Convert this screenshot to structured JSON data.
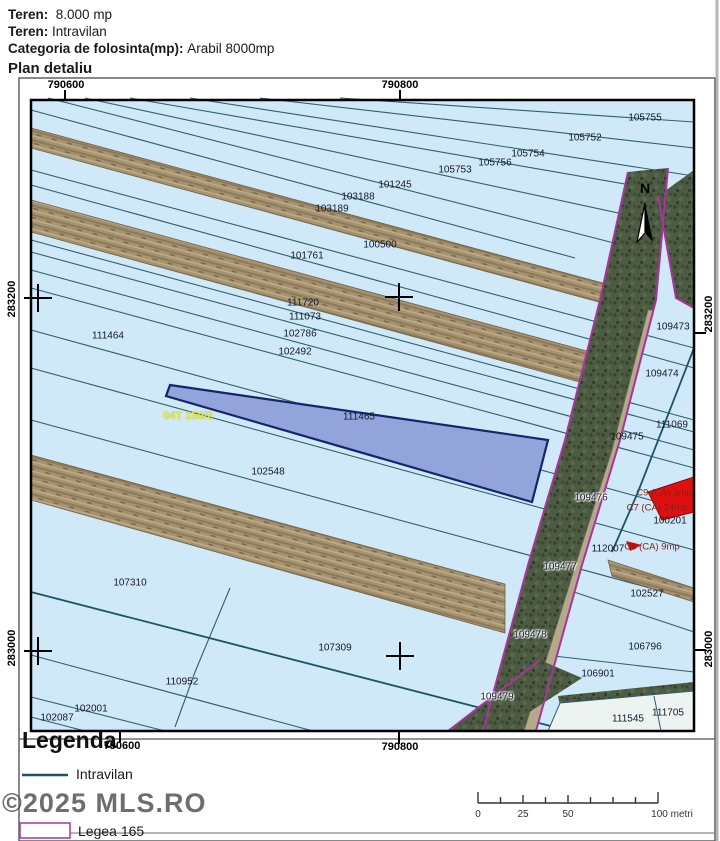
{
  "header": {
    "line1_label": "Teren:",
    "line1_value": "8.000 mp",
    "line2_label": "Teren:",
    "line2_value": "Intravilan",
    "line3_label": "Categoria de folosinta(mp):",
    "line3_value": "Arabil 8000mp",
    "title": "Plan detaliu"
  },
  "legend": {
    "title": "Legenda",
    "items": [
      {
        "symbol": "teal-line",
        "label": "Intravilan"
      },
      {
        "symbol": "magenta-rect",
        "label": "Legea 165"
      }
    ]
  },
  "watermark": "©2025 MLS.RO",
  "scale": {
    "labels": [
      "0",
      "25",
      "50",
      "100 metri"
    ]
  },
  "colors": {
    "map_bg": "#cfe9f8",
    "parcel_line": "#2f6070",
    "highlight_fill": "#93a4da",
    "highlight_border": "#16246e",
    "band_tan": "#a5926f",
    "band_green": "#4d5b43",
    "legea_magenta": "#a8359c",
    "intravilan_teal": "#1d5366",
    "red_parcel": "#e01010",
    "yellow_label": "#e9e93f"
  },
  "map": {
    "labels": [
      {
        "t": "790600",
        "x": 66,
        "y": 85,
        "c": "coord",
        "n": "coord-top-790600"
      },
      {
        "t": "790800",
        "x": 400,
        "y": 85,
        "c": "coord",
        "n": "coord-top-790800"
      },
      {
        "t": "790600",
        "x": 122,
        "y": 746,
        "c": "coord",
        "n": "coord-bottom-790600"
      },
      {
        "t": "790800",
        "x": 400,
        "y": 747,
        "c": "coord",
        "n": "coord-bottom-790800"
      },
      {
        "t": "283200",
        "x": 12,
        "y": 299,
        "c": "coordv",
        "n": "coord-left-283200"
      },
      {
        "t": "283000",
        "x": 12,
        "y": 648,
        "c": "coordv",
        "n": "coord-left-283000"
      },
      {
        "t": "283200",
        "x": 709,
        "y": 314,
        "c": "coordv",
        "n": "coord-right-283200"
      },
      {
        "t": "283000",
        "x": 709,
        "y": 649,
        "c": "coordv",
        "n": "coord-right-283000"
      },
      {
        "t": "N",
        "x": 645,
        "y": 188,
        "c": "n",
        "n": "north-label"
      },
      {
        "t": "105755",
        "x": 645,
        "y": 118
      },
      {
        "t": "105752",
        "x": 585,
        "y": 138
      },
      {
        "t": "105754",
        "x": 528,
        "y": 154
      },
      {
        "t": "105756",
        "x": 495,
        "y": 163
      },
      {
        "t": "105753",
        "x": 455,
        "y": 170
      },
      {
        "t": "101245",
        "x": 395,
        "y": 185
      },
      {
        "t": "103188",
        "x": 358,
        "y": 197
      },
      {
        "t": "103189",
        "x": 332,
        "y": 209
      },
      {
        "t": "100500",
        "x": 380,
        "y": 245
      },
      {
        "t": "101761",
        "x": 307,
        "y": 256
      },
      {
        "t": "111720",
        "x": 303,
        "y": 303
      },
      {
        "t": "111073",
        "x": 305,
        "y": 317
      },
      {
        "t": "102786",
        "x": 300,
        "y": 334
      },
      {
        "t": "102492",
        "x": 295,
        "y": 352
      },
      {
        "t": "111464",
        "x": 108,
        "y": 336
      },
      {
        "t": "111465",
        "x": 359,
        "y": 417
      },
      {
        "t": "04T 150/2",
        "x": 188,
        "y": 416,
        "c": "y",
        "n": "tarla-label"
      },
      {
        "t": "102548",
        "x": 268,
        "y": 472
      },
      {
        "t": "107310",
        "x": 130,
        "y": 583
      },
      {
        "t": "107309",
        "x": 335,
        "y": 648
      },
      {
        "t": "110952",
        "x": 182,
        "y": 682
      },
      {
        "t": "102001",
        "x": 91,
        "y": 709
      },
      {
        "t": "102087",
        "x": 57,
        "y": 718
      },
      {
        "t": "109473",
        "x": 673,
        "y": 327
      },
      {
        "t": "109474",
        "x": 662,
        "y": 374
      },
      {
        "t": "111069",
        "x": 672,
        "y": 425
      },
      {
        "t": "109475",
        "x": 627,
        "y": 437
      },
      {
        "t": "109476",
        "x": 591,
        "y": 498,
        "c": "halo"
      },
      {
        "t": "109477",
        "x": 560,
        "y": 567,
        "c": "halo"
      },
      {
        "t": "109478",
        "x": 530,
        "y": 635,
        "c": "halo"
      },
      {
        "t": "109479",
        "x": 497,
        "y": 697,
        "c": "halo"
      },
      {
        "t": "112007",
        "x": 608,
        "y": 549
      },
      {
        "t": "100201",
        "x": 670,
        "y": 521
      },
      {
        "t": "C9 (CA) 3mp",
        "x": 664,
        "y": 493,
        "c": "c",
        "n": "construction-label"
      },
      {
        "t": "C7 (CA) 24mp",
        "x": 657,
        "y": 508,
        "c": "c",
        "n": "construction-label"
      },
      {
        "t": "C8 (CA) 9mp",
        "x": 652,
        "y": 547,
        "c": "c",
        "n": "construction-label"
      },
      {
        "t": "102527",
        "x": 647,
        "y": 594
      },
      {
        "t": "106796",
        "x": 645,
        "y": 647
      },
      {
        "t": "106901",
        "x": 598,
        "y": 674
      },
      {
        "t": "111545",
        "x": 628,
        "y": 719
      },
      {
        "t": "111705",
        "x": 668,
        "y": 713
      }
    ]
  }
}
